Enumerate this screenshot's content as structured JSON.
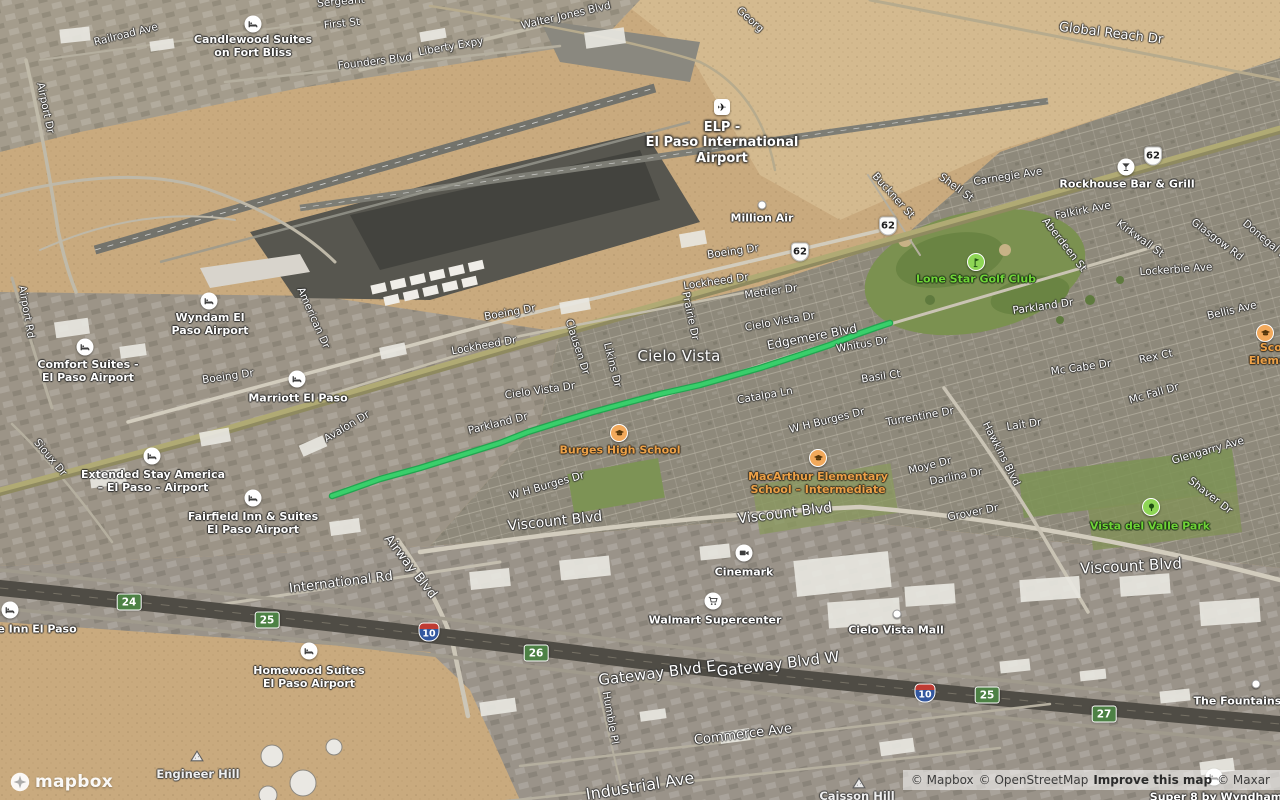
{
  "logo": {
    "wordmark": "mapbox"
  },
  "attribution": {
    "mapbox": "© Mapbox",
    "osm": "© OpenStreetMap",
    "improve": "Improve this map",
    "maxar": "© Maxar"
  },
  "map": {
    "route": {
      "color": "#39cf6b",
      "casing_color": "#22a550",
      "points": [
        [
          332,
          496
        ],
        [
          352,
          489
        ],
        [
          380,
          479
        ],
        [
          420,
          468
        ],
        [
          465,
          454
        ],
        [
          500,
          443
        ],
        [
          528,
          432
        ],
        [
          560,
          422
        ],
        [
          593,
          412
        ],
        [
          630,
          402
        ],
        [
          660,
          394
        ],
        [
          700,
          385
        ],
        [
          735,
          375
        ],
        [
          760,
          368
        ],
        [
          800,
          355
        ],
        [
          830,
          345
        ],
        [
          858,
          334
        ],
        [
          875,
          328
        ],
        [
          890,
          323
        ]
      ]
    },
    "shields": [
      {
        "system": "us-highway",
        "number": "62",
        "x": 800,
        "y": 252
      },
      {
        "system": "us-highway",
        "number": "62",
        "x": 888,
        "y": 226
      },
      {
        "system": "us-highway",
        "number": "62",
        "x": 1153,
        "y": 156
      },
      {
        "system": "interstate",
        "number": "10",
        "x": 429,
        "y": 632
      },
      {
        "system": "interstate",
        "number": "10",
        "x": 925,
        "y": 693
      },
      {
        "system": "exit",
        "number": "24",
        "x": 129,
        "y": 602
      },
      {
        "system": "exit",
        "number": "25",
        "x": 267,
        "y": 620
      },
      {
        "system": "exit",
        "number": "26",
        "x": 536,
        "y": 653
      },
      {
        "system": "exit",
        "number": "25",
        "x": 987,
        "y": 695
      },
      {
        "system": "exit",
        "number": "27",
        "x": 1104,
        "y": 714
      }
    ],
    "labels": [
      {
        "text": "Railroad Ave",
        "x": 126,
        "y": 35,
        "rot": -14,
        "type": "street"
      },
      {
        "text": "First St",
        "x": 342,
        "y": 24,
        "rot": -6,
        "type": "street"
      },
      {
        "text": "Sergeant",
        "x": 341,
        "y": 2,
        "rot": -5,
        "type": "street"
      },
      {
        "text": "Founders Blvd",
        "x": 375,
        "y": 62,
        "rot": -7,
        "type": "street"
      },
      {
        "text": "Liberty Expy",
        "x": 451,
        "y": 47,
        "rot": -10,
        "type": "street"
      },
      {
        "text": "Walter Jones Blvd",
        "x": 566,
        "y": 16,
        "rot": -13,
        "type": "street"
      },
      {
        "text": "Georg",
        "x": 750,
        "y": 20,
        "rot": 42,
        "type": "street"
      },
      {
        "text": "Global Reach Dr",
        "x": 1111,
        "y": 34,
        "rot": 7,
        "size": 13,
        "type": "street"
      },
      {
        "text": "Carnegie Ave",
        "x": 1008,
        "y": 177,
        "rot": -9,
        "type": "street"
      },
      {
        "text": "Buckner St",
        "x": 893,
        "y": 196,
        "rot": 48,
        "type": "street"
      },
      {
        "text": "Shell St",
        "x": 956,
        "y": 188,
        "rot": 36,
        "type": "street"
      },
      {
        "text": "Boeing Dr",
        "x": 733,
        "y": 252,
        "rot": -8,
        "type": "street"
      },
      {
        "text": "Lockheed Dr",
        "x": 716,
        "y": 282,
        "rot": -8,
        "type": "street"
      },
      {
        "text": "Mettler Dr",
        "x": 771,
        "y": 292,
        "rot": -8,
        "type": "street"
      },
      {
        "text": "Boeing Dr",
        "x": 510,
        "y": 313,
        "rot": -10,
        "type": "street"
      },
      {
        "text": "Lockheed Dr",
        "x": 484,
        "y": 346,
        "rot": -10,
        "type": "street"
      },
      {
        "text": "Boeing Dr",
        "x": 228,
        "y": 377,
        "rot": -8,
        "type": "street"
      },
      {
        "text": "Cielo Vista Dr",
        "x": 780,
        "y": 322,
        "rot": -10,
        "type": "street"
      },
      {
        "text": "Cielo Vista Dr",
        "x": 540,
        "y": 391,
        "rot": -8,
        "type": "street"
      },
      {
        "text": "Falkirk Ave",
        "x": 1083,
        "y": 211,
        "rot": -11,
        "type": "street"
      },
      {
        "text": "Aberdeen St",
        "x": 1064,
        "y": 245,
        "rot": 52,
        "type": "street"
      },
      {
        "text": "Kirkwall St",
        "x": 1140,
        "y": 239,
        "rot": 36,
        "type": "street"
      },
      {
        "text": "Glasgow Rd",
        "x": 1217,
        "y": 240,
        "rot": 37,
        "type": "street"
      },
      {
        "text": "Donegal St",
        "x": 1266,
        "y": 241,
        "rot": 40,
        "type": "street"
      },
      {
        "text": "Lockerbie Ave",
        "x": 1176,
        "y": 270,
        "rot": -4,
        "type": "street"
      },
      {
        "text": "Bellis Ave",
        "x": 1232,
        "y": 311,
        "rot": -13,
        "type": "street"
      },
      {
        "text": "Parkland Dr",
        "x": 1043,
        "y": 307,
        "rot": -8,
        "type": "street"
      },
      {
        "text": "Rex Ct",
        "x": 1156,
        "y": 357,
        "rot": -12,
        "type": "street"
      },
      {
        "text": "Mc Cabe Dr",
        "x": 1081,
        "y": 368,
        "rot": -8,
        "type": "street"
      },
      {
        "text": "Mc Fall Dr",
        "x": 1154,
        "y": 394,
        "rot": -16,
        "type": "street"
      },
      {
        "text": "Edgemere Blvd",
        "x": 812,
        "y": 337,
        "rot": -11,
        "size": 12,
        "type": "street"
      },
      {
        "text": "Whitus Dr",
        "x": 862,
        "y": 345,
        "rot": -10,
        "type": "street"
      },
      {
        "text": "Basil Ct",
        "x": 881,
        "y": 377,
        "rot": -8,
        "type": "street"
      },
      {
        "text": "Catalpa Ln",
        "x": 765,
        "y": 396,
        "rot": -10,
        "type": "street"
      },
      {
        "text": "Clausen Dr",
        "x": 577,
        "y": 347,
        "rot": 72,
        "type": "street"
      },
      {
        "text": "Likins Dr",
        "x": 612,
        "y": 365,
        "rot": 76,
        "type": "street"
      },
      {
        "text": "Prairie Dr",
        "x": 690,
        "y": 316,
        "rot": 78,
        "type": "street"
      },
      {
        "text": "American Dr",
        "x": 313,
        "y": 318,
        "rot": 66,
        "type": "street"
      },
      {
        "text": "Airport Rd",
        "x": 26,
        "y": 312,
        "rot": 80,
        "type": "street"
      },
      {
        "text": "Airport Dr",
        "x": 45,
        "y": 108,
        "rot": 78,
        "type": "street"
      },
      {
        "text": "Sioux Dr",
        "x": 50,
        "y": 458,
        "rot": 50,
        "type": "street"
      },
      {
        "text": "Avalon Dr",
        "x": 347,
        "y": 427,
        "rot": -31,
        "type": "street"
      },
      {
        "text": "Parkland Dr",
        "x": 498,
        "y": 424,
        "rot": -14,
        "type": "street"
      },
      {
        "text": "W H Burges Dr",
        "x": 547,
        "y": 486,
        "rot": -16,
        "type": "street"
      },
      {
        "text": "W H Burges Dr",
        "x": 827,
        "y": 421,
        "rot": -14,
        "type": "street"
      },
      {
        "text": "Turrentine Dr",
        "x": 920,
        "y": 417,
        "rot": -10,
        "type": "street"
      },
      {
        "text": "Hawkins Blvd",
        "x": 1001,
        "y": 454,
        "rot": 63,
        "type": "street"
      },
      {
        "text": "Lait Dr",
        "x": 1024,
        "y": 425,
        "rot": -8,
        "type": "street"
      },
      {
        "text": "Moye Dr",
        "x": 930,
        "y": 466,
        "rot": -14,
        "type": "street"
      },
      {
        "text": "Darlina Dr",
        "x": 956,
        "y": 477,
        "rot": -11,
        "type": "street"
      },
      {
        "text": "Grover Dr",
        "x": 973,
        "y": 513,
        "rot": -11,
        "type": "street"
      },
      {
        "text": "Glengarry Ave",
        "x": 1208,
        "y": 451,
        "rot": -16,
        "type": "street"
      },
      {
        "text": "Shaver Dr",
        "x": 1210,
        "y": 496,
        "rot": 38,
        "type": "street"
      },
      {
        "text": "Viscount Blvd",
        "x": 555,
        "y": 522,
        "rot": -6,
        "size": 14,
        "type": "street-big"
      },
      {
        "text": "Viscount Blvd",
        "x": 785,
        "y": 514,
        "rot": -7,
        "size": 14,
        "type": "street-big"
      },
      {
        "text": "Viscount Blvd",
        "x": 1131,
        "y": 566,
        "rot": -3,
        "size": 15,
        "type": "street-big"
      },
      {
        "text": "Airway Blvd",
        "x": 410,
        "y": 567,
        "rot": 52,
        "size": 13,
        "type": "street"
      },
      {
        "text": "International Rd",
        "x": 341,
        "y": 583,
        "rot": -7,
        "size": 13,
        "type": "street"
      },
      {
        "text": "Gateway Blvd E",
        "x": 657,
        "y": 673,
        "rot": -7,
        "size": 15,
        "type": "street-big"
      },
      {
        "text": "Gateway Blvd W",
        "x": 778,
        "y": 664,
        "rot": -7,
        "size": 15,
        "type": "street-big"
      },
      {
        "text": "Commerce Ave",
        "x": 743,
        "y": 735,
        "rot": -7,
        "size": 13,
        "type": "street"
      },
      {
        "text": "Industrial Ave",
        "x": 640,
        "y": 786,
        "rot": -9,
        "size": 16,
        "type": "street-big"
      },
      {
        "text": "Humble Pl",
        "x": 610,
        "y": 718,
        "rot": 80,
        "type": "street"
      },
      {
        "text": "Cielo Vista",
        "x": 679,
        "y": 356,
        "rot": 0,
        "type": "neighborhood"
      },
      {
        "lines": [
          "ELP -",
          "El Paso International",
          "Airport"
        ],
        "x": 722,
        "y": 143,
        "type": "airport",
        "icon": "airport",
        "icon_x": 722,
        "icon_y": 107
      },
      {
        "lines": [
          "Candlewood Suites",
          "on Fort Bliss"
        ],
        "x": 253,
        "y": 46,
        "type": "poi",
        "icon": "lodging",
        "icon_x": 253,
        "icon_y": 24
      },
      {
        "lines": [
          "Wyndam El",
          "Paso Airport"
        ],
        "x": 210,
        "y": 324,
        "type": "poi",
        "icon": "lodging",
        "icon_x": 209,
        "icon_y": 301
      },
      {
        "lines": [
          "Comfort Suites -",
          "El Paso Airport"
        ],
        "x": 88,
        "y": 371,
        "type": "poi",
        "icon": "lodging",
        "icon_x": 85,
        "icon_y": 347
      },
      {
        "text": "Marriott El Paso",
        "x": 298,
        "y": 398,
        "type": "poi",
        "icon": "lodging",
        "icon_x": 297,
        "icon_y": 379
      },
      {
        "lines": [
          "Extended Stay America",
          "– El Paso – Airport"
        ],
        "x": 153,
        "y": 481,
        "type": "poi",
        "icon": "lodging",
        "icon_x": 152,
        "icon_y": 456
      },
      {
        "lines": [
          "Fairfield Inn & Suites",
          "El Paso Airport"
        ],
        "x": 253,
        "y": 523,
        "type": "poi",
        "icon": "lodging",
        "icon_x": 253,
        "icon_y": 498
      },
      {
        "text": "e Inn El Paso",
        "x": 37,
        "y": 629,
        "type": "poi",
        "icon": "lodging",
        "icon_x": 10,
        "icon_y": 610
      },
      {
        "lines": [
          "Homewood Suites",
          "El Paso Airport"
        ],
        "x": 309,
        "y": 677,
        "type": "poi",
        "icon": "lodging",
        "icon_x": 309,
        "icon_y": 651
      },
      {
        "text": "Super 8 by Wyndham",
        "x": 1216,
        "y": 797,
        "type": "poi",
        "icon": "lodging",
        "icon_x": 1214,
        "icon_y": 777
      },
      {
        "text": "Million Air",
        "x": 762,
        "y": 218,
        "type": "poi",
        "icon": "dot",
        "icon_x": 762,
        "icon_y": 205
      },
      {
        "text": "Rockhouse Bar & Grill",
        "x": 1127,
        "y": 184,
        "type": "poi",
        "icon": "bar",
        "icon_x": 1126,
        "icon_y": 167
      },
      {
        "text": "Cinemark",
        "x": 744,
        "y": 572,
        "type": "poi",
        "icon": "cinema",
        "icon_x": 744,
        "icon_y": 553
      },
      {
        "text": "Walmart Supercenter",
        "x": 715,
        "y": 620,
        "type": "poi",
        "icon": "grocery",
        "icon_x": 713,
        "icon_y": 601
      },
      {
        "text": "Cielo Vista Mall",
        "x": 896,
        "y": 630,
        "type": "poi",
        "icon": "dot",
        "icon_x": 897,
        "icon_y": 614
      },
      {
        "text": "The Fountains a",
        "x": 1243,
        "y": 701,
        "type": "poi",
        "icon": "dot",
        "icon_x": 1256,
        "icon_y": 684
      },
      {
        "text": "Burges High School",
        "x": 620,
        "y": 450,
        "type": "school",
        "icon": "school",
        "icon_x": 619,
        "icon_y": 433
      },
      {
        "lines": [
          "MacArthur Elementary",
          "School – Intermediate"
        ],
        "x": 818,
        "y": 483,
        "type": "school",
        "icon": "school",
        "icon_x": 818,
        "icon_y": 458
      },
      {
        "lines": [
          "Scotsdale",
          "Elementary S"
        ],
        "x": 1290,
        "y": 354,
        "type": "school",
        "icon": "school",
        "icon_x": 1265,
        "icon_y": 333
      },
      {
        "text": "Lone Star Golf Club",
        "x": 976,
        "y": 279,
        "type": "park",
        "icon": "golf",
        "icon_x": 976,
        "icon_y": 262
      },
      {
        "text": "Vista del Valle Park",
        "x": 1150,
        "y": 526,
        "type": "park",
        "icon": "tree",
        "icon_x": 1151,
        "icon_y": 507
      },
      {
        "text": "Engineer Hill",
        "x": 198,
        "y": 775,
        "type": "hill",
        "icon": "hill",
        "icon_x": 197,
        "icon_y": 756
      },
      {
        "text": "Caisson Hill",
        "x": 857,
        "y": 797,
        "type": "hill",
        "icon": "hill",
        "icon_x": 859,
        "icon_y": 783
      }
    ]
  }
}
